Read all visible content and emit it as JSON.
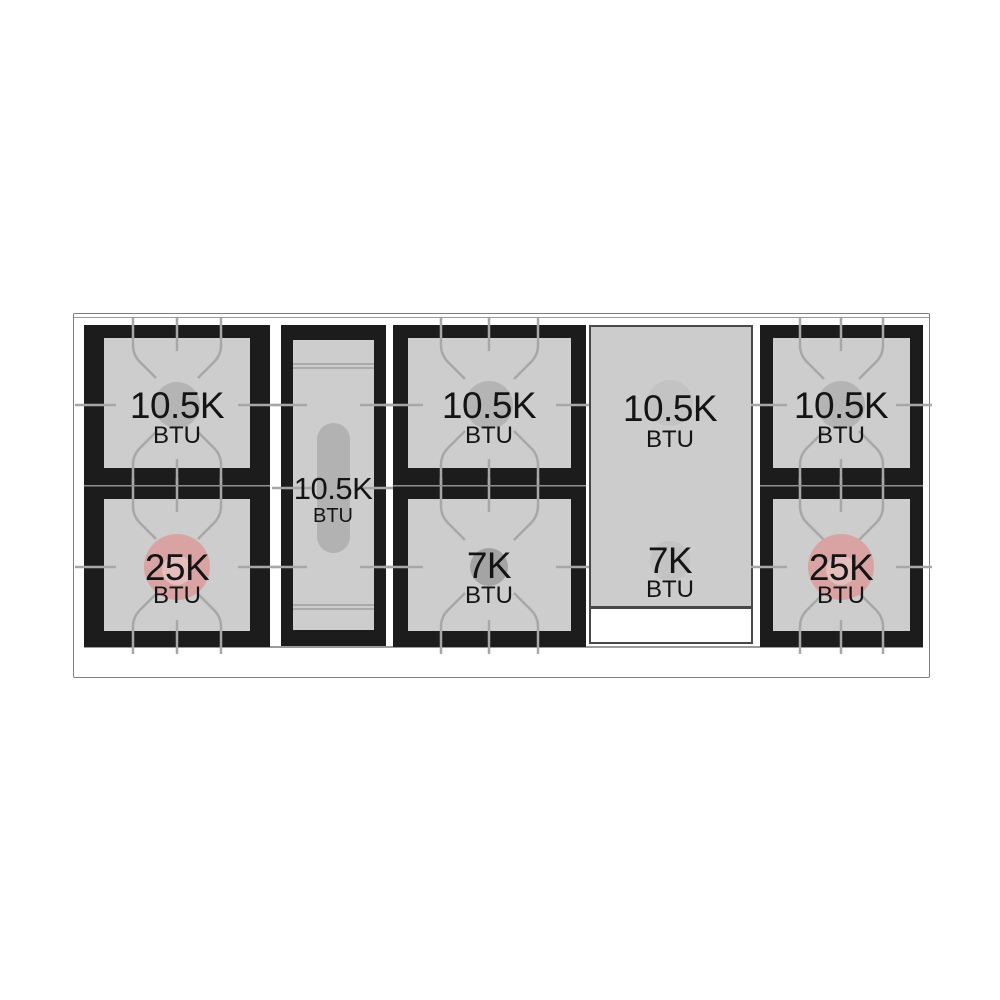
{
  "diagram": {
    "type": "range-cooktop-burner-layout",
    "unit": "BTU",
    "burners": {
      "left_top": {
        "power": "10.5K",
        "unit": "BTU",
        "kind": "standard"
      },
      "left_bottom": {
        "power": "25K",
        "unit": "BTU",
        "kind": "power"
      },
      "center_oval": {
        "power": "10.5K",
        "unit": "BTU",
        "kind": "oval"
      },
      "middle_top": {
        "power": "10.5K",
        "unit": "BTU",
        "kind": "standard"
      },
      "middle_bottom": {
        "power": "7K",
        "unit": "BTU",
        "kind": "small"
      },
      "griddle_top": {
        "power": "10.5K",
        "unit": "BTU",
        "kind": "griddle"
      },
      "griddle_bottom": {
        "power": "7K",
        "unit": "BTU",
        "kind": "griddle"
      },
      "right_top": {
        "power": "10.5K",
        "unit": "BTU",
        "kind": "standard"
      },
      "right_bottom": {
        "power": "25K",
        "unit": "BTU",
        "kind": "power"
      }
    },
    "colors": {
      "power_burner": "#d9a3a3",
      "power_burner_inner": "#e4bdbd",
      "standard_burner": "#b4b4b4",
      "small_burner": "#a4a4a4",
      "oval_burner": "#b2b2b2",
      "griddle_burner": "#c3c3c3",
      "surface": "#cdcdcd",
      "grate_black": "#1c1c1c",
      "grate_line": "#a7a7a7"
    }
  }
}
